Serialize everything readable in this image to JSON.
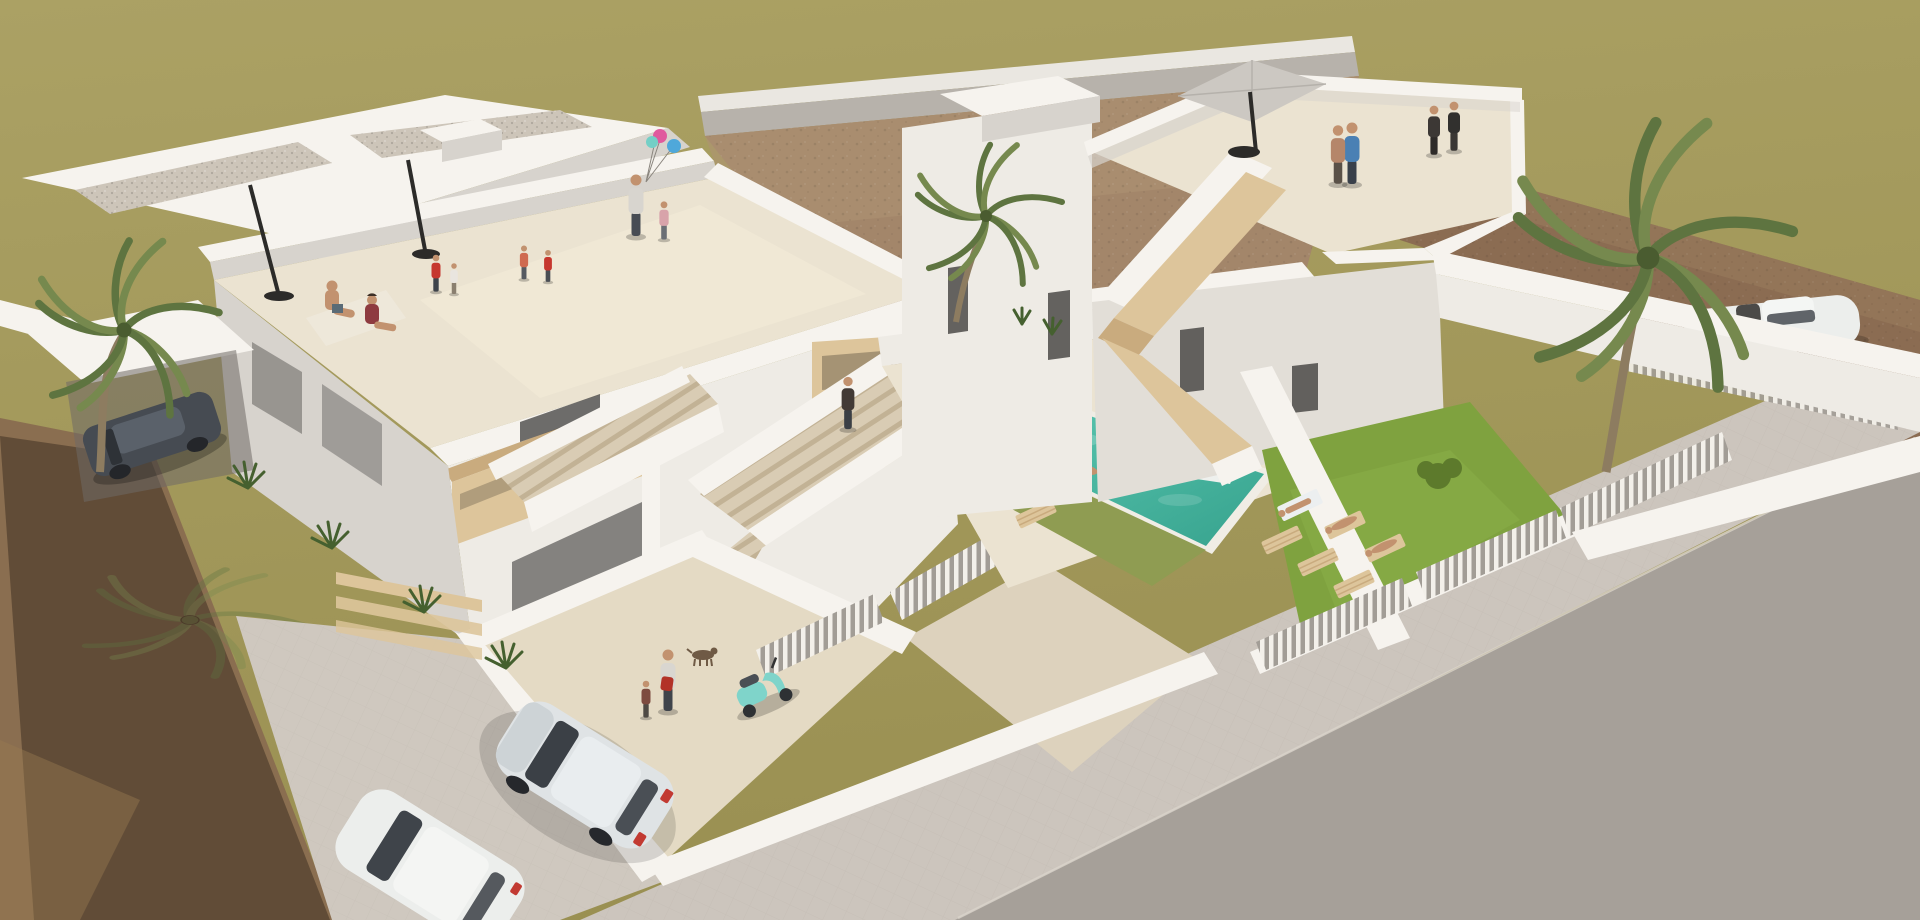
{
  "scene": {
    "description": "Aerial 3D architectural rendering of a new-build residential development: a two-storey white apartment building on the left with people relaxing on rooftop terraces, a detached white villa on the right with a roof terrace, parasol and tan exterior staircases, a turquoise swimming pool with swimmers and an air mattress, a green garden with sun loungers and sunbathers, palm trees, parked cars, a teal scooter, white perimeter walls and slatted fences, a paved sidewalk and grey street in the foreground, and empty khaki and brown dirt plots behind.",
    "objects": [
      "left-apartment-building",
      "rooftop-terrace",
      "gravel-roof",
      "closed-parasols",
      "sitting-couple",
      "woman-with-balloons",
      "children-playing",
      "exterior-staircase",
      "wood-balcony",
      "carport",
      "dark-car",
      "courtyard",
      "man-with-dog",
      "red-backpack",
      "teal-scooter",
      "slatted-fence",
      "swimming-pool",
      "swimmers",
      "air-mattress",
      "sun-loungers",
      "right-villa",
      "roof-parasol",
      "people-on-roof",
      "tan-staircase",
      "garden-lawn",
      "sunbathers",
      "white-car-in-drive",
      "silver-hatchback",
      "white-car-street",
      "palm-trees",
      "sidewalk",
      "street",
      "dirt-plots",
      "khaki-field"
    ]
  },
  "colors": {
    "khaki": "#a49a5c",
    "khakiLight": "#ada364",
    "dirtCenter": "#a3866a",
    "dirtRight": "#8b6c52",
    "dirtFore": "#8a6e50",
    "road": "#a6a099",
    "sidewalk": "#ccc5bd",
    "wallWhite": "#f6f3ee",
    "wallLight": "#eeebe5",
    "wallMid": "#e2ded7",
    "wallShade": "#d7d3cd",
    "floorCream": "#ebe3d1",
    "floorCream2": "#e4dac4",
    "wood": "#ddc59b",
    "woodShade": "#c9ab7e",
    "stepTan": "#d9ccb4",
    "window": "#4b4a48",
    "pool": "#42b19d",
    "poolDeep": "#2f9d8a",
    "grass": "#7fa23f",
    "grassOlive": "#8f9c52",
    "grassDark": "#5d7a2c",
    "palmGreen": "#5e7440",
    "palmLight": "#76894e",
    "trunk": "#8d7c60",
    "skin": "#c2926f",
    "umbrella": "#ccc8c2",
    "pole": "#2c2b29",
    "carSilver": "#dfe3e5",
    "carDark": "#464b52",
    "carWhite": "#eceeec",
    "scooter": "#7fd4ca"
  }
}
